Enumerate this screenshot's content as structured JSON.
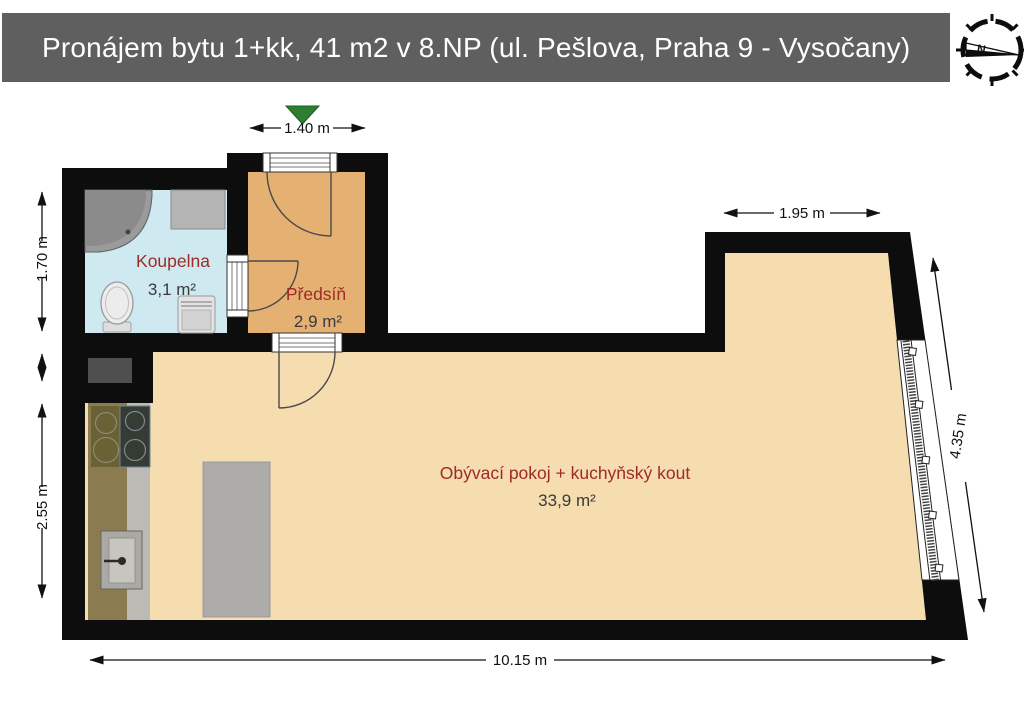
{
  "header": {
    "title": "Pronájem bytu 1+kk, 41 m2 v 8.NP (ul. Pešlova, Praha 9 - Vysočany)",
    "bar_color": "#5f5f5f",
    "compass": {
      "north_label": "N"
    }
  },
  "floor_plan": {
    "rooms": [
      {
        "name": "Koupelna",
        "area": "3,1 m²",
        "floor_color": "#cfe9f1"
      },
      {
        "name": "Předsíň",
        "area": "2,9 m²",
        "floor_color": "#e5b173"
      },
      {
        "name": "Obývací pokoj + kuchyňský kout",
        "area": "33,9 m²",
        "floor_color": "#f5ddb0"
      }
    ],
    "dimensions": {
      "entry_width": "1.40 m",
      "top_right_width": "1.95 m",
      "bathroom_height": "1.70 m",
      "kitchen_height": "2.55 m",
      "total_width": "10.15 m",
      "window_wall_length": "4.35 m"
    },
    "colors": {
      "wall": "#0d0d0d",
      "room_label": "#9e2b25",
      "area_label": "#3a3a3a",
      "entrance_marker": "#2e7d32"
    }
  }
}
